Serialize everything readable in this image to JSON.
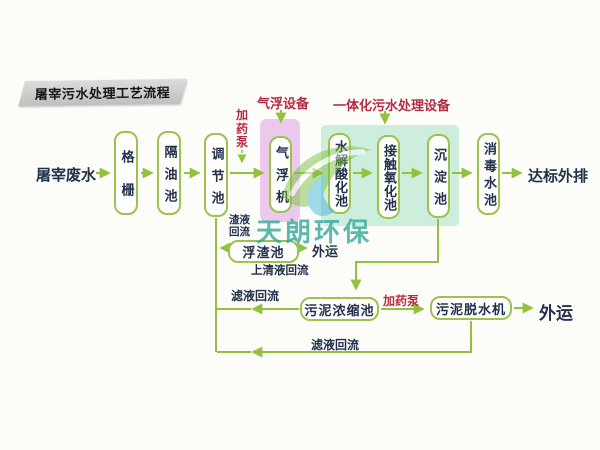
{
  "title": "屠宰污水处理工艺流程",
  "watermark": "天朗环保",
  "flow": {
    "influent": "屠宰废水",
    "effluent": "达标外排"
  },
  "tanks": {
    "grid": "格栅",
    "oil_separator": "隔油池",
    "regulating": "调节池",
    "air_flotation": "气浮机",
    "hydrolysis": "水解酸化池",
    "contact_oxidation": "接触氧化池",
    "sedimentation": "沉淀池",
    "disinfection": "消毒水池",
    "scum": "浮渣池",
    "sludge_thickener": "污泥浓缩池",
    "sludge_dewatering": "污泥脱水机"
  },
  "labels": {
    "flotation_equipment": "气浮设备",
    "integrated_equipment": "一体化污水处理设备",
    "dosing_pump_top": "加药泵",
    "dosing_pump_bottom": "加药泵",
    "slag_reflux": "渣液回流",
    "supernatant_reflux": "上清液回流",
    "filtrate_reflux_thickener": "滤液回流",
    "filtrate_reflux_dewatering": "滤液回流",
    "outbound_scum": "外运",
    "outbound_sludge": "外运"
  },
  "colors": {
    "line_green": "#94c13d",
    "box_border_green": "#9cc34c",
    "label_red": "#b42b44",
    "text_dark": "#22304a",
    "pink_highlight": "#ecc9ec",
    "green_highlight": "#cdeedd",
    "watermark_teal": "#35a89b",
    "banner_gray": "#c9c9c9"
  }
}
